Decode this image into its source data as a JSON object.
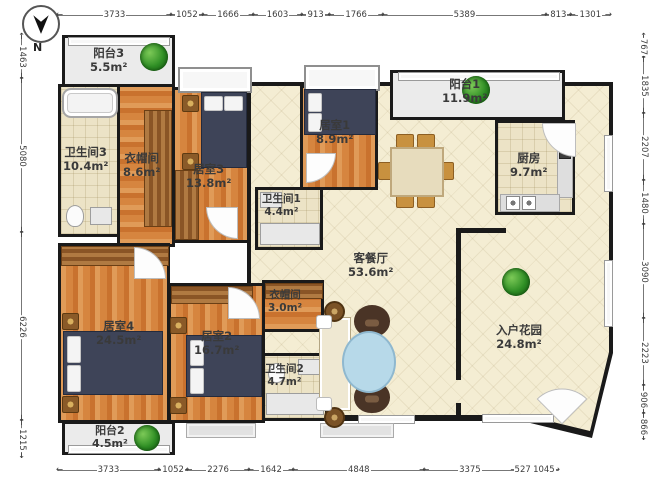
{
  "compass": {
    "label": "N"
  },
  "dimensions": {
    "top": [
      "3733",
      "1052",
      "1666",
      "1603",
      "913",
      "1766",
      "5389",
      "813",
      "1301"
    ],
    "bottom": [
      "3733",
      "1052",
      "2276",
      "1642",
      "4848",
      "3375",
      "527",
      "1045"
    ],
    "left": [
      "1463",
      "5080",
      "6226",
      "1215"
    ],
    "right": [
      "767",
      "1835",
      "2207",
      "1480",
      "3090",
      "2223",
      "906",
      "866"
    ]
  },
  "rooms": {
    "balcony3": {
      "name": "阳台3",
      "area": "5.5m²"
    },
    "bath3": {
      "name": "卫生间3",
      "area": "10.4m²"
    },
    "cloak3": {
      "name": "衣帽间",
      "area": "8.6m²"
    },
    "bed3": {
      "name": "居室3",
      "area": "13.8m²"
    },
    "bed1": {
      "name": "居室1",
      "area": "8.9m²"
    },
    "bath1": {
      "name": "卫生间1",
      "area": "4.4m²"
    },
    "balcony1": {
      "name": "阳台1",
      "area": "11.9m²"
    },
    "kitchen": {
      "name": "厨房",
      "area": "9.7m²"
    },
    "living": {
      "name": "客餐厅",
      "area": "53.6m²"
    },
    "cloak2": {
      "name": "衣帽间",
      "area": "3.0m²"
    },
    "bath2": {
      "name": "卫生间2",
      "area": "4.7m²"
    },
    "bed4": {
      "name": "居室4",
      "area": "24.5m²"
    },
    "bed2": {
      "name": "居室2",
      "area": "16.7m²"
    },
    "garden": {
      "name": "入户花园",
      "area": "24.8m²"
    },
    "balcony2": {
      "name": "阳台2",
      "area": "4.5m²"
    }
  },
  "colors": {
    "wall": "#1a1a1a",
    "wood_floor": "#d6853f",
    "tile_floor": "#ece3c6",
    "living_floor": "#f4edd3",
    "balcony_floor": "#ebebeb",
    "bed": "#3e4458",
    "plant": "#2f8f25",
    "coffee_table": "#b7d9e9"
  }
}
